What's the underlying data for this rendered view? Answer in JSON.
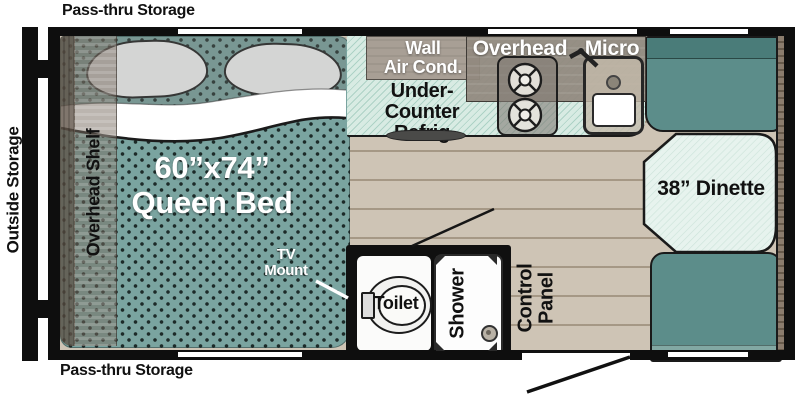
{
  "floorplan": {
    "exterior": {
      "top_storage_label": "Pass-thru Storage",
      "bottom_storage_label": "Pass-thru Storage",
      "side_storage_label": "Outside Storage"
    },
    "bedroom": {
      "shelf_label": "Overhead Shelf",
      "bed_size_label": "60”x74”",
      "bed_type_label": "Queen Bed",
      "tv_label_line1": "TV",
      "tv_label_line2": "Mount"
    },
    "kitchen": {
      "wall_ac_line1": "Wall",
      "wall_ac_line2": "Air Cond.",
      "refrig_line1": "Under-",
      "refrig_line2": "Counter",
      "refrig_line3": "Refrig",
      "overhead_label": "Overhead",
      "micro_label": "Micro"
    },
    "dinette": {
      "label": "38” Dinette"
    },
    "bathroom": {
      "toilet_label": "Toilet",
      "shower_label": "Shower",
      "control_line1": "Control",
      "control_line2": "Panel"
    },
    "colors": {
      "bed_teal": "#7aa4a0",
      "cushion_teal": "#5c8d8a",
      "table_mint": "#e7f3ee",
      "counter_mint": "#d8ebe3",
      "floor_tan": "#cec4b5",
      "cabinet_gray": "#928a7e",
      "wall_black": "#0e0e0e"
    }
  }
}
